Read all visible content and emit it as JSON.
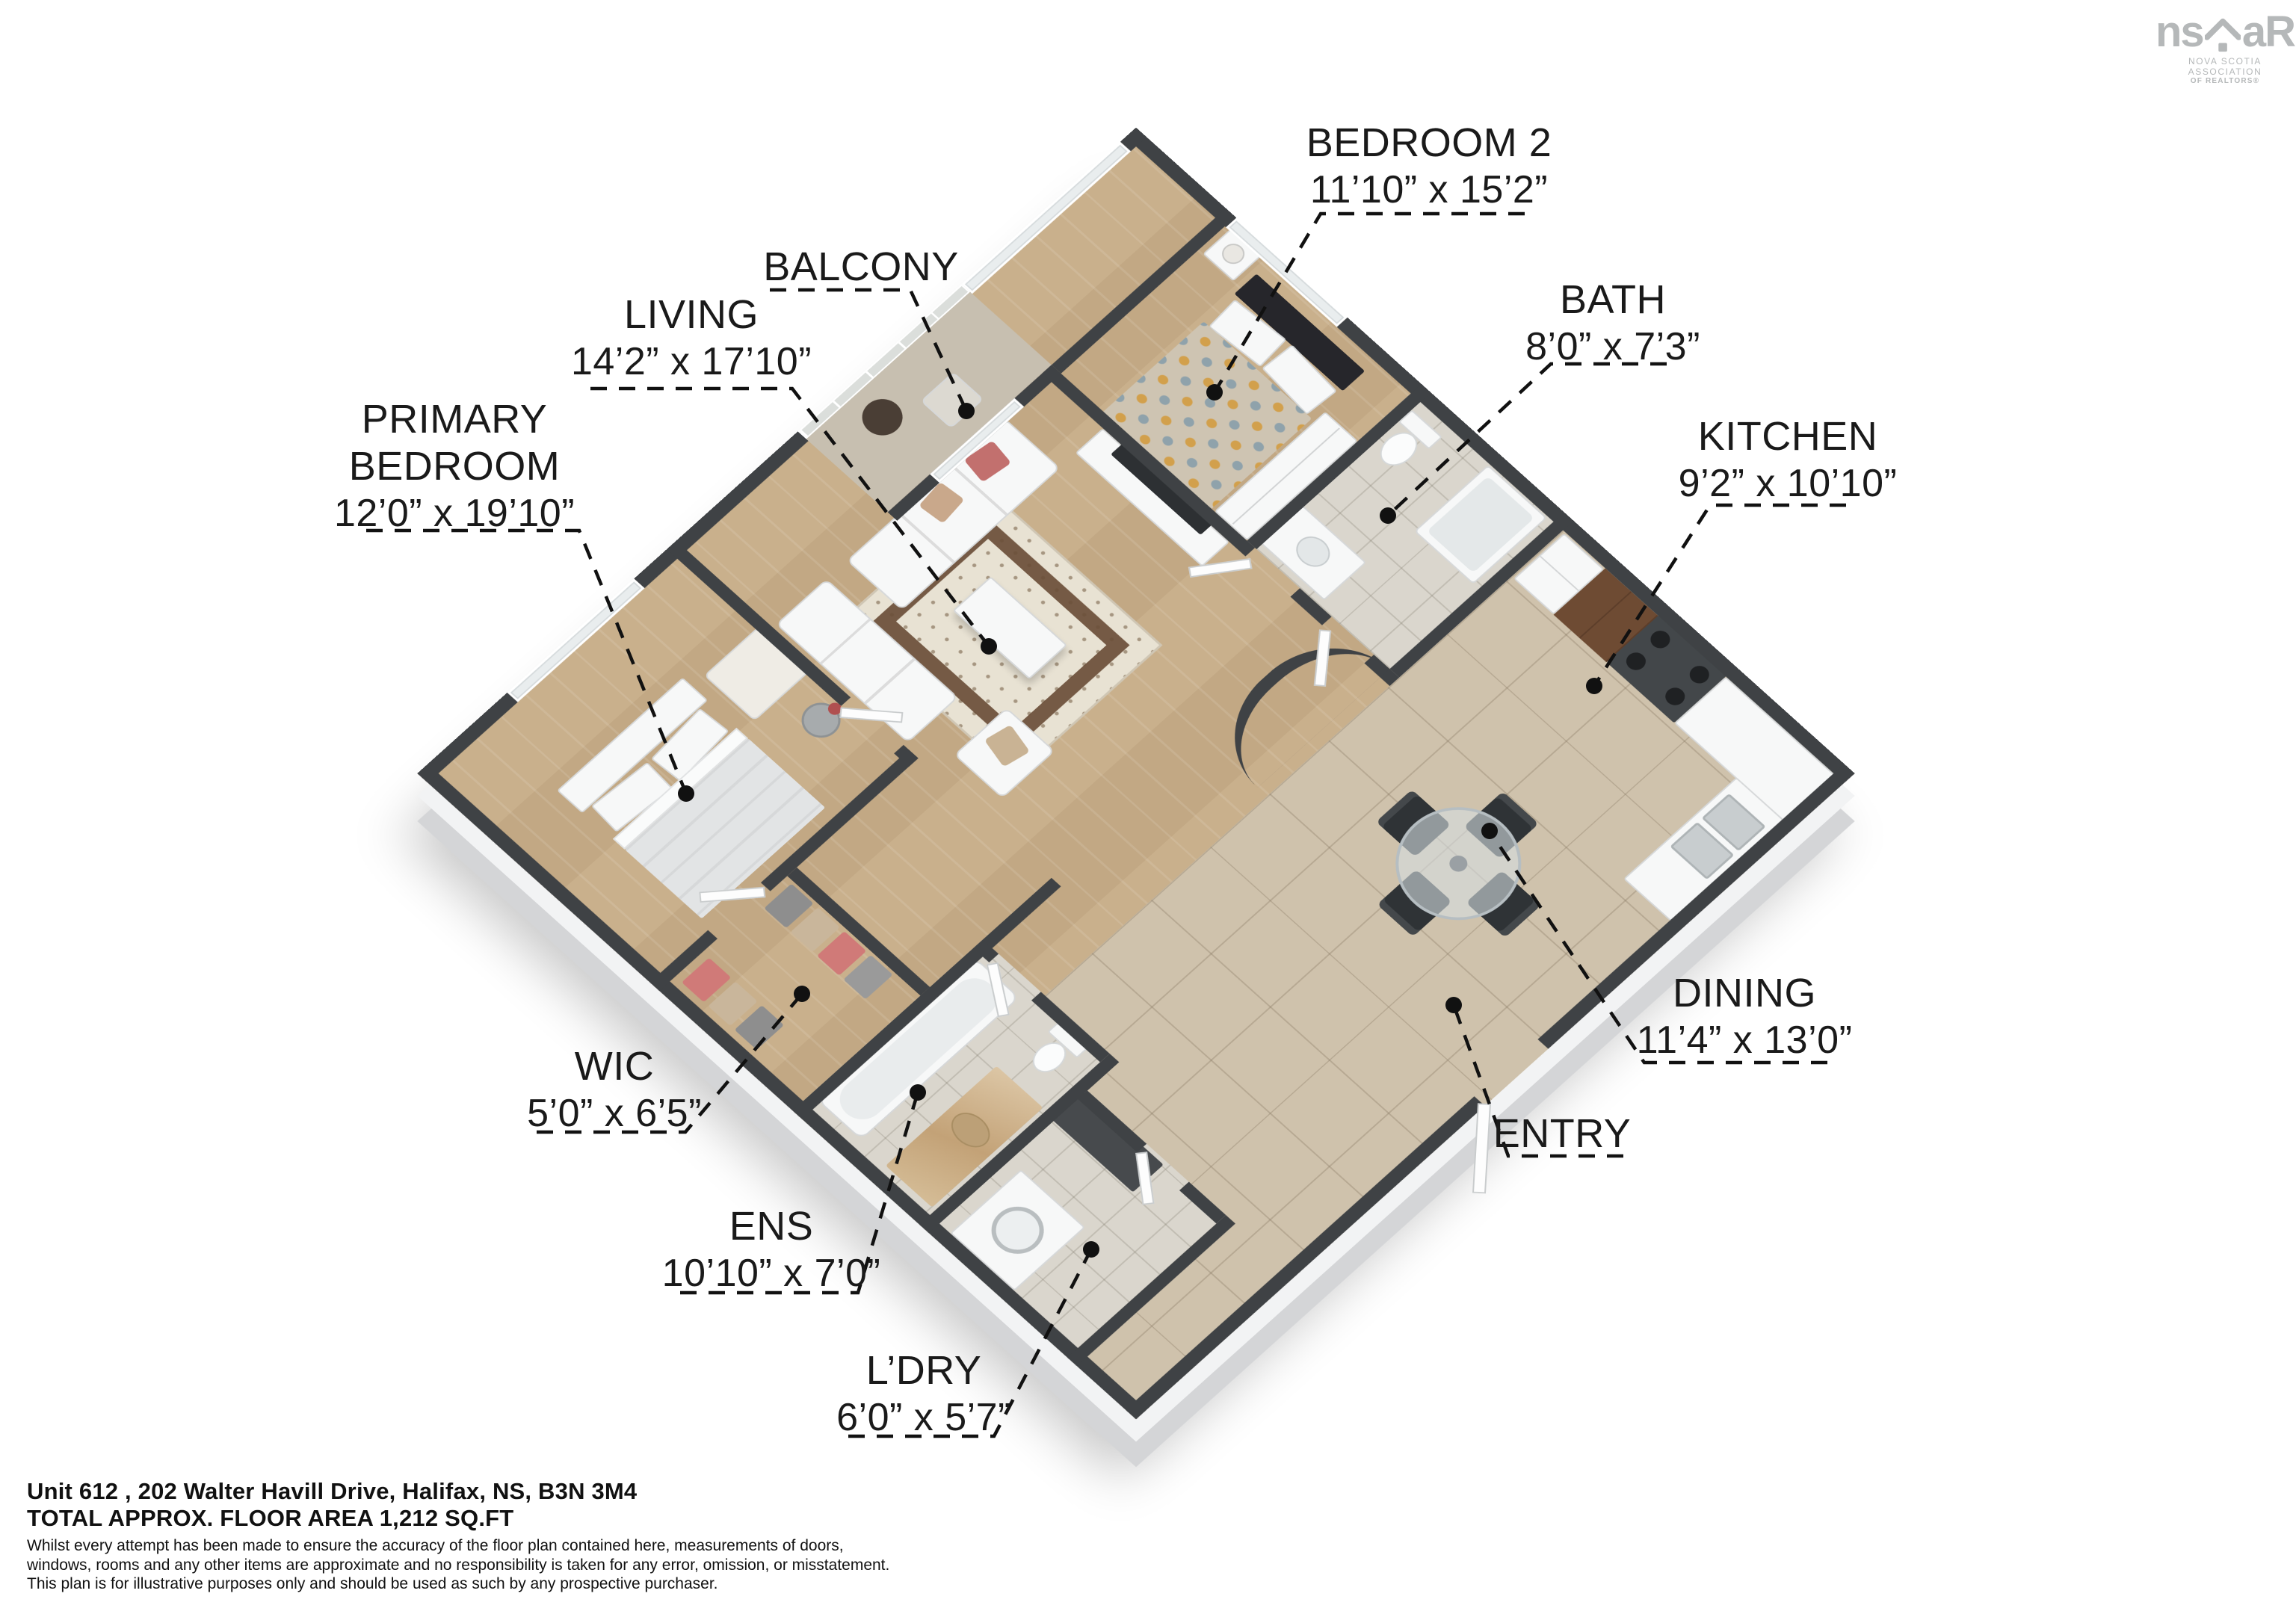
{
  "branding": {
    "logo_text_left": "ns",
    "logo_text_right": "aR",
    "tagline_line1": "NOVA SCOTIA ASSOCIATION",
    "tagline_line2": "OF REALTORS®",
    "logo_color": "#b5b8b9"
  },
  "rooms": [
    {
      "name": "BEDROOM 2",
      "dims": "11’10” x 15’2”"
    },
    {
      "name": "BALCONY",
      "dims": ""
    },
    {
      "name": "LIVING",
      "dims": "14’2” x 17’10”"
    },
    {
      "name": "PRIMARY BEDROOM",
      "dims": "12’0” x 19’10”"
    },
    {
      "name": "BATH",
      "dims": "8’0” x 7’3”"
    },
    {
      "name": "KITCHEN",
      "dims": "9’2” x 10’10”"
    },
    {
      "name": "DINING",
      "dims": "11’4” x 13’0”"
    },
    {
      "name": "ENTRY",
      "dims": ""
    },
    {
      "name": "WIC",
      "dims": "5’0” x 6’5”"
    },
    {
      "name": "ENS",
      "dims": "10’10” x 7’0”"
    },
    {
      "name": "L’DRY",
      "dims": "6’0” x 5’7”"
    }
  ],
  "footer": {
    "address": "Unit 612 , 202 Walter Havill Drive, Halifax, NS, B3N 3M4",
    "area": "TOTAL APPROX. FLOOR AREA 1,212 SQ.FT",
    "disclaimer_line1": "Whilst every attempt has been made to ensure the accuracy of the floor plan contained here, measurements of doors,",
    "disclaimer_line2": "windows, rooms and any other items are approximate and no responsibility is taken for any error, omission, or misstatement.",
    "disclaimer_line3": "This plan is for illustrative purposes only and should be used as such by any prospective purchaser."
  },
  "colors": {
    "wall_cap": "#3f4245",
    "wood_floor": "#c9b08c",
    "tile_beige": "#cfc2ac",
    "tile_light": "#dad6cd",
    "label_text": "#1a1a1a",
    "leader": "#111111"
  }
}
